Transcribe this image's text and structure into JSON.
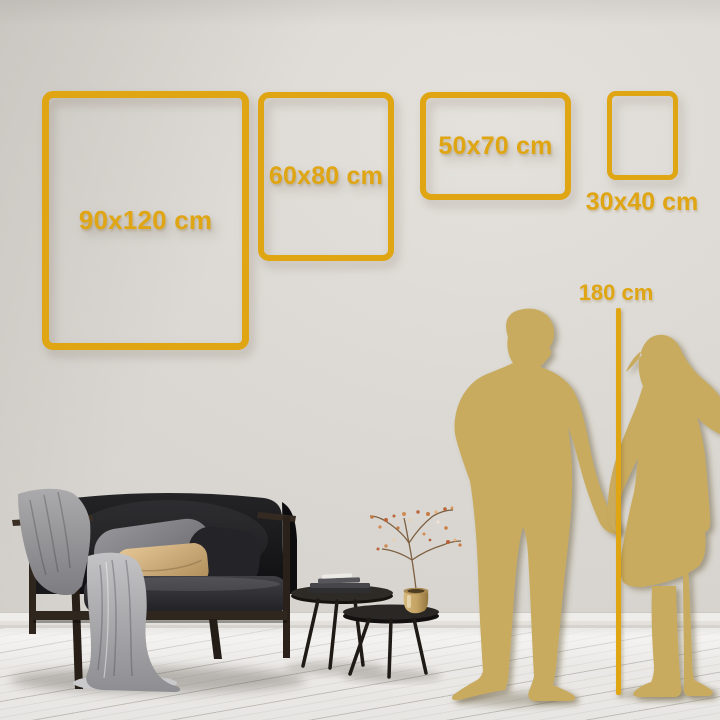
{
  "size_guide": {
    "frames": [
      {
        "id": "90x120",
        "label": "90x120 cm",
        "width_cm": 90,
        "height_cm": 120,
        "orientation": "portrait",
        "label_position": "inside"
      },
      {
        "id": "60x80",
        "label": "60x80 cm",
        "width_cm": 60,
        "height_cm": 80,
        "orientation": "portrait",
        "label_position": "inside"
      },
      {
        "id": "50x70",
        "label": "50x70 cm",
        "width_cm": 50,
        "height_cm": 70,
        "orientation": "landscape",
        "label_position": "inside"
      },
      {
        "id": "30x40",
        "label": "30x40 cm",
        "width_cm": 30,
        "height_cm": 40,
        "orientation": "portrait",
        "label_position": "below"
      }
    ],
    "height_reference": {
      "label": "180 cm",
      "value_cm": 180
    }
  },
  "colors": {
    "gold_accent": "#DFA513",
    "silhouette_gold": "#C8AB5E",
    "wall_light": "#E4E1DC",
    "wall_dark": "#D2CFCA",
    "floor_light": "#EDEBE8"
  },
  "scene": {
    "description": "Poster size comparison guide on a living-room wall; man and woman silhouettes holding hands serve as a 180 cm height reference",
    "objects": [
      "dark sofa with gray throw blanket and pillows",
      "two round nesting coffee tables with books and a brass vase holding a dried branch",
      "whitewashed plank floor",
      "gold wire wall frames in four sizes"
    ]
  }
}
